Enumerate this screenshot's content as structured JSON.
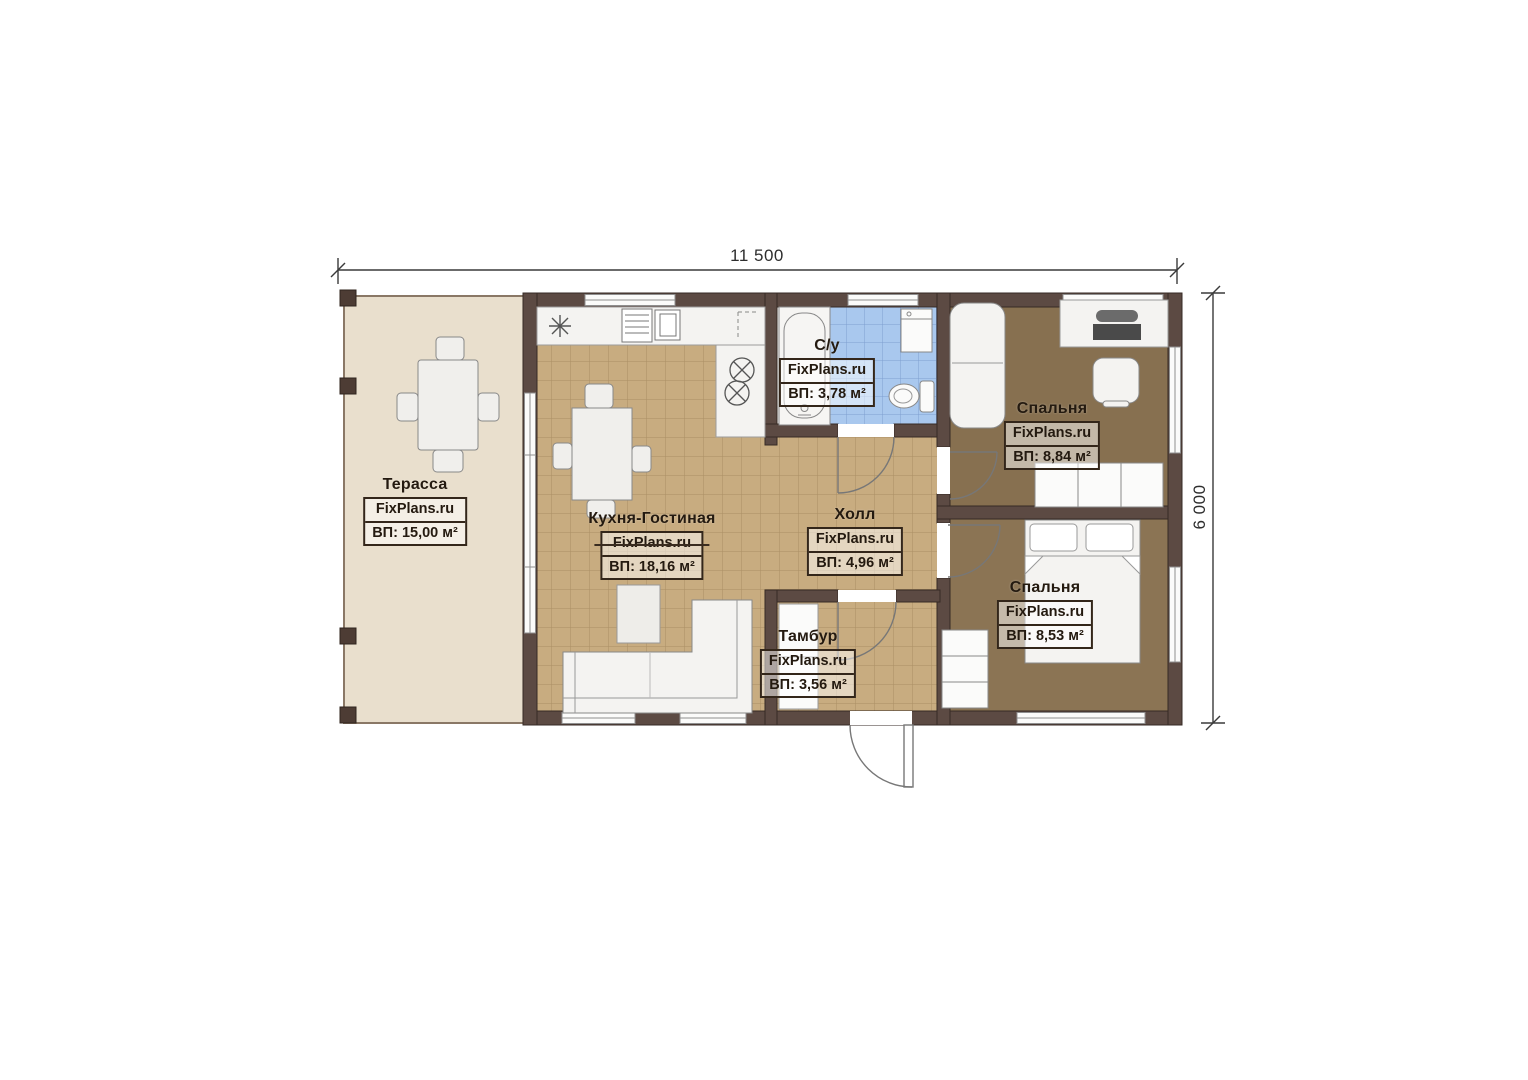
{
  "watermark": "FixPlans.ru",
  "dimensions": {
    "width": "11 500",
    "height": "6 000"
  },
  "rooms": {
    "terrace": {
      "name": "Терасса",
      "area": "ВП: 15,00 м²"
    },
    "kitchen_living": {
      "name": "Кухня-Гостиная",
      "area": "ВП: 18,16 м²"
    },
    "bathroom": {
      "name": "С/у",
      "area": "ВП: 3,78 м²"
    },
    "hall": {
      "name": "Холл",
      "area": "ВП: 4,96 м²"
    },
    "vestibule": {
      "name": "Тамбур",
      "area": "ВП: 3,56 м²"
    },
    "bedroom_top": {
      "name": "Спальня",
      "area": "ВП: 8,84 м²"
    },
    "bedroom_bottom": {
      "name": "Спальня",
      "area": "ВП: 8,53 м²"
    }
  },
  "colors": {
    "wall": "#5c4a43",
    "floor_tile_tan": "#c8ac80",
    "floor_tile_blue": "#a9c8ee",
    "floor_bedroom": "#877050",
    "floor_terrace": "#e9dfcd"
  }
}
